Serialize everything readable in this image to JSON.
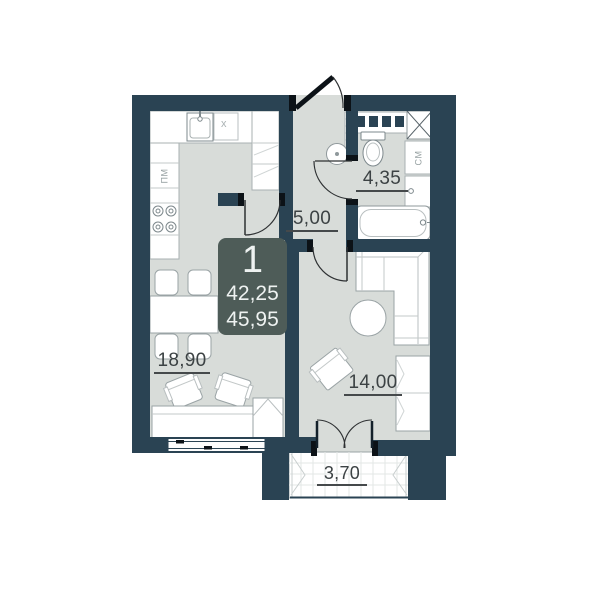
{
  "plan": {
    "badge": {
      "unit_number": "1",
      "area_upper": "42,25",
      "area_lower": "45,95"
    },
    "rooms": [
      {
        "name": "kitchen-living-room",
        "area_label": "18,90"
      },
      {
        "name": "hallway",
        "area_label": "5,00"
      },
      {
        "name": "bathroom",
        "area_label": "4,35"
      },
      {
        "name": "living-room",
        "area_label": "14,00"
      },
      {
        "name": "balcony",
        "area_label": "3,70"
      }
    ],
    "appliances": {
      "dishwasher_label": "ПМ",
      "washing_machine_label": "СМ",
      "cabinet_mark": "x"
    },
    "colors": {
      "wall": "#2a4353",
      "floor": "#d8dcd9",
      "badge_bg": "#4e5c58",
      "badge_text": "#eef2f1",
      "label_text": "#3c4244"
    }
  }
}
